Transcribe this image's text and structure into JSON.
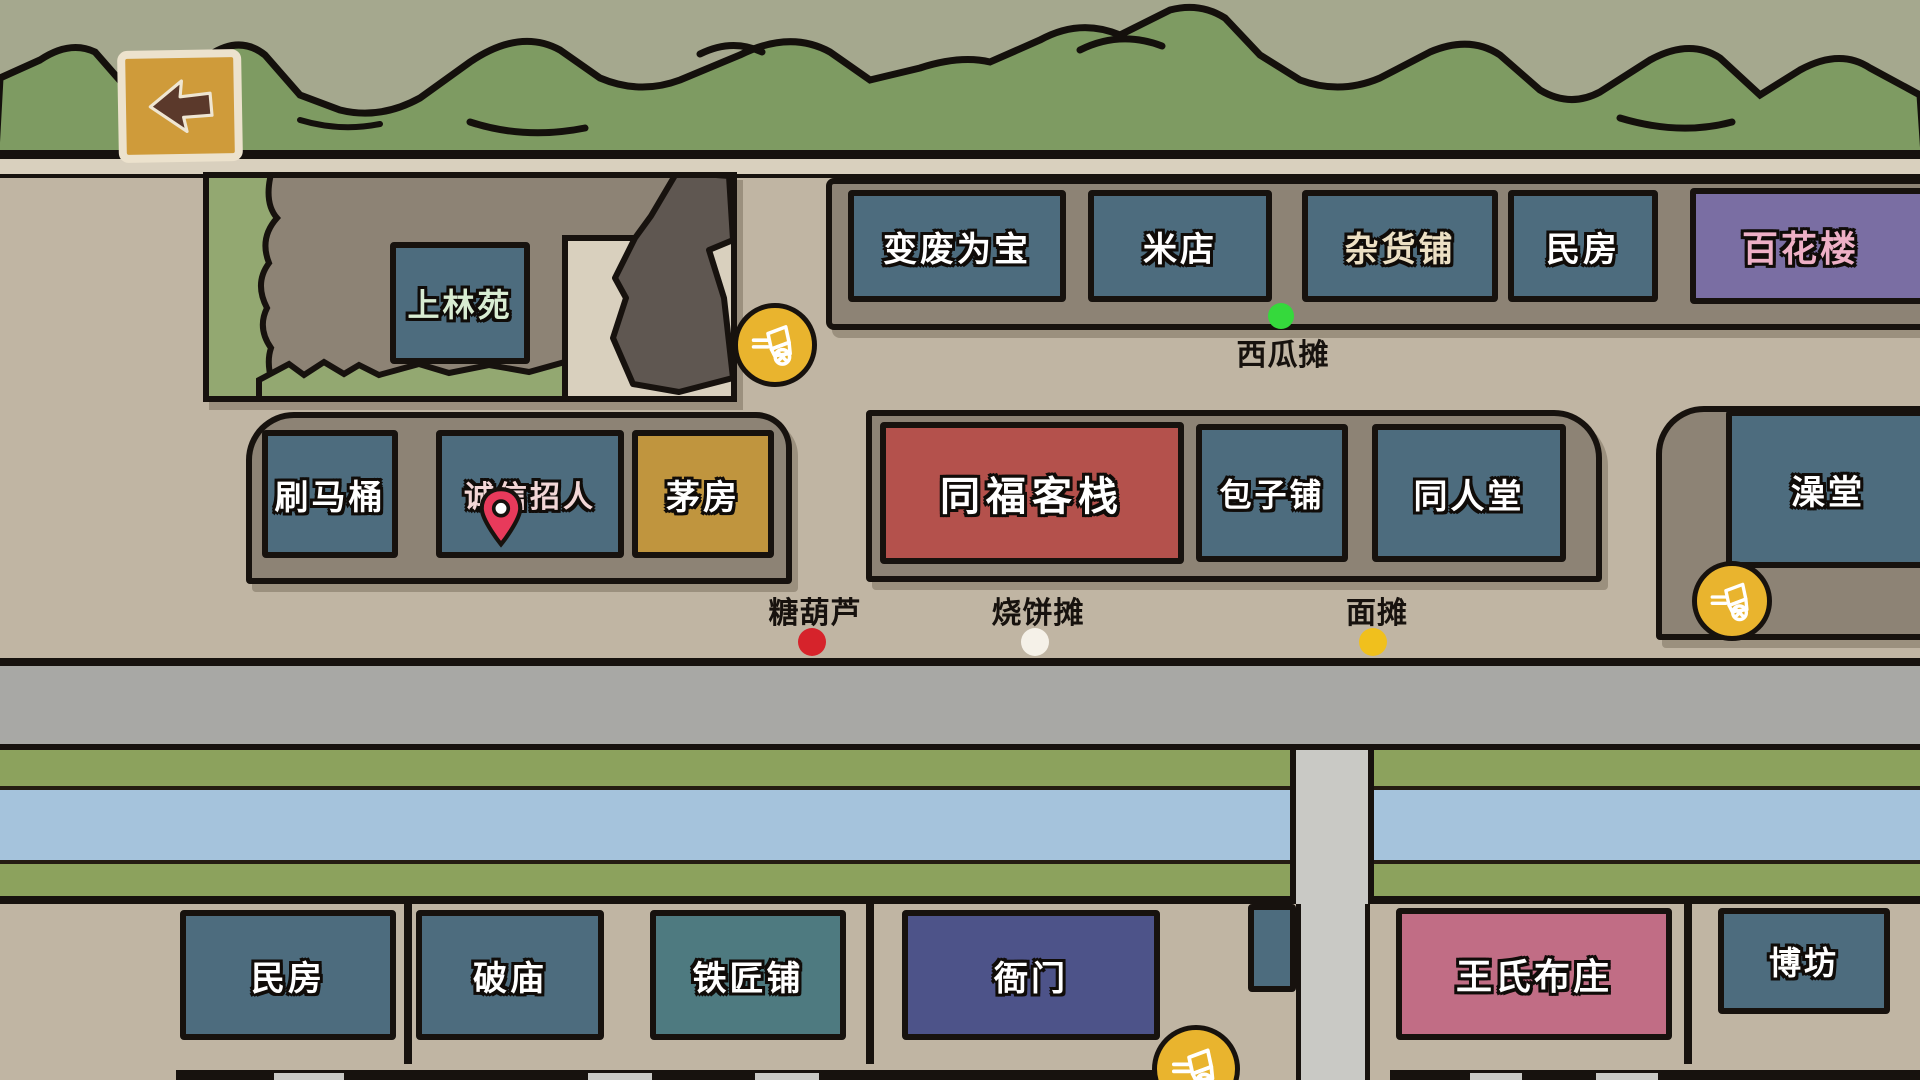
{
  "screen": "town-map",
  "back_button": {
    "icon": "back-arrow-icon"
  },
  "buildings": {
    "garden": {
      "label": "上林苑",
      "color": "#4d6c7e",
      "text_color": "#d8ecd2"
    },
    "recycle": {
      "label": "变废为宝",
      "color": "#4d6c7e",
      "text_color": "#ffffff"
    },
    "rice_shop": {
      "label": "米店",
      "color": "#4d6c7e",
      "text_color": "#ffffff"
    },
    "grocery": {
      "label": "杂货铺",
      "color": "#4d6c7e",
      "text_color": "#ece0c4"
    },
    "house_top": {
      "label": "民房",
      "color": "#4d6c7e",
      "text_color": "#ffffff"
    },
    "flower_tower": {
      "label": "百花楼",
      "color": "#7a6ea3",
      "text_color": "#eeb0c6"
    },
    "toilet_brush": {
      "label": "刷马桶",
      "color": "#4d6c7e",
      "text_color": "#ffffff"
    },
    "recruit": {
      "label": "诚信招人",
      "color": "#4d6c7e",
      "text_color": "#f2d6d6",
      "marker": "location-pin"
    },
    "outhouse": {
      "label": "茅房",
      "color": "#c0953e",
      "text_color": "#ffffff"
    },
    "tongfu_inn": {
      "label": "同福客栈",
      "color": "#b4514c",
      "text_color": "#ffffff"
    },
    "baozi_shop": {
      "label": "包子铺",
      "color": "#4d6c7e",
      "text_color": "#ffffff"
    },
    "tongren_hall": {
      "label": "同人堂",
      "color": "#4d6c7e",
      "text_color": "#ffffff"
    },
    "bathhouse": {
      "label": "澡堂",
      "color": "#4d6c7e",
      "text_color": "#ffffff"
    },
    "house_bottom": {
      "label": "民房",
      "color": "#4d6c7e",
      "text_color": "#ffffff"
    },
    "ruined_temple": {
      "label": "破庙",
      "color": "#4d6c7e",
      "text_color": "#ffffff"
    },
    "blacksmith": {
      "label": "铁匠铺",
      "color": "#4e7a80",
      "text_color": "#ffffff"
    },
    "yamen": {
      "label": "衙门",
      "color": "#4d5389",
      "text_color": "#ffffff"
    },
    "wang_cloth": {
      "label": "王氏布庄",
      "color": "#c16d85",
      "text_color": "#ffffff"
    },
    "gambling_house": {
      "label": "博坊",
      "color": "#4d6c7e",
      "text_color": "#ffffff"
    }
  },
  "stalls": {
    "watermelon": {
      "label": "西瓜摊",
      "dot_color": "#35d93c"
    },
    "tanghulu": {
      "label": "糖葫芦",
      "dot_color": "#d6232b"
    },
    "shaobing": {
      "label": "烧饼摊",
      "dot_color": "#f5f1e8"
    },
    "noodle": {
      "label": "面摊",
      "dot_color": "#f0c01d"
    }
  },
  "icons": {
    "vendor_cart_count": 3,
    "vendor_cart": "street-vendor-cart-icon",
    "marker": "location-pin-icon"
  },
  "colors": {
    "street": "#c0b5a3",
    "block": "#8d8375",
    "building_default": "#4d6c7e",
    "road": "#a8a8a5",
    "river": "#a5c3dc",
    "bank_green": "#8ca25d",
    "mountain_green": "#7e9b62",
    "sky_olive": "#a5a88e",
    "outline": "#17120e",
    "cart_yellow": "#e9b42e",
    "pin_red": "#e83a5b",
    "back_btn_gold": "#cf9b3a"
  }
}
